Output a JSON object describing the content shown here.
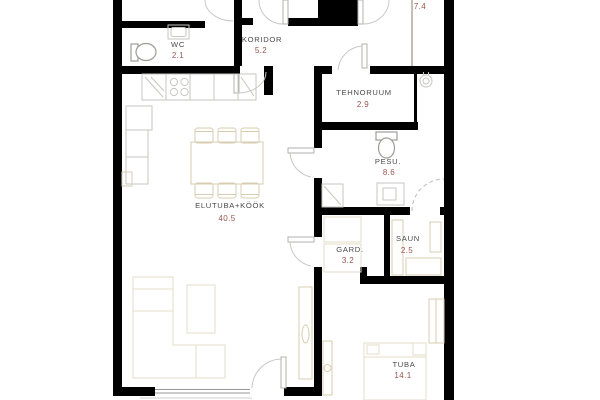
{
  "plan": {
    "type": "apartment-floor-plan",
    "background_color": "#ffffff",
    "wall_color": "#000000",
    "room_name_color": "#4a4a4a",
    "room_area_color": "#9c554d",
    "furniture_outline_tan": "#d8cdb2",
    "furniture_outline_gray": "#c6c6c2",
    "rooms": [
      {
        "name": "WC",
        "area": "2.1"
      },
      {
        "name": "KORIDOR",
        "area": "5.2"
      },
      {
        "name": "TEHNORUUM",
        "area": "2.9"
      },
      {
        "name": "PESU.",
        "area": "8.6"
      },
      {
        "name": "GARD.",
        "area": "3.2"
      },
      {
        "name": "SAUN",
        "area": "2.5"
      },
      {
        "name": "ELUTUBA+KÖÖK",
        "area": "40.5"
      },
      {
        "name": "TUBA",
        "area": "14.1"
      },
      {
        "name": "",
        "area": "7.4"
      }
    ]
  }
}
